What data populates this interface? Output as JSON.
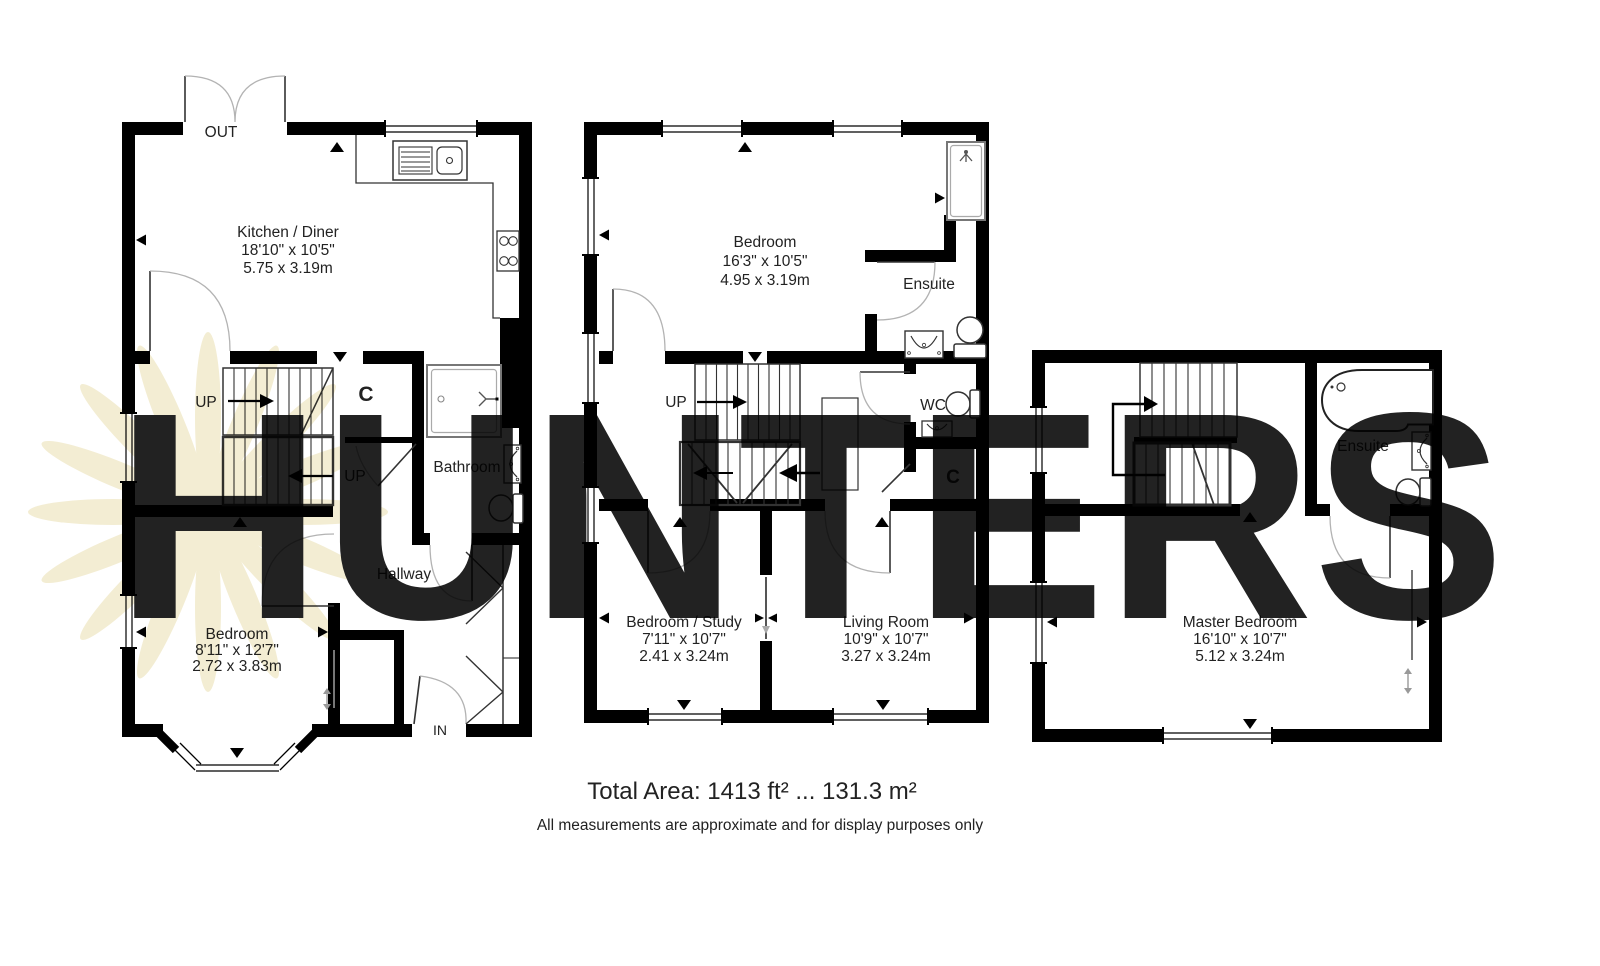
{
  "watermark": {
    "text": "HUNTERS",
    "color": "#F0E8C0"
  },
  "footer": {
    "total_area": "Total Area: 1413 ft² ... 131.3 m²",
    "disclaimer": "All measurements are approximate and for display purposes only"
  },
  "ground_floor": {
    "kitchen": {
      "name": "Kitchen / Diner",
      "imperial": "18'10\" x 10'5\"",
      "metric": "5.75 x 3.19m"
    },
    "bedroom": {
      "name": "Bedroom",
      "imperial": "8'11\" x 12'7\"",
      "metric": "2.72 x 3.83m"
    },
    "bathroom_label": "Bathroom",
    "hallway_label": "Hallway",
    "door_out": "OUT",
    "door_in": "IN",
    "up_label_1": "UP",
    "up_label_2": "UP",
    "cupboard_label": "C"
  },
  "first_floor": {
    "bedroom": {
      "name": "Bedroom",
      "imperial": "16'3\" x 10'5\"",
      "metric": "4.95 x 3.19m"
    },
    "bedroom_study": {
      "name": "Bedroom / Study",
      "imperial": "7'11\" x 10'7\"",
      "metric": "2.41 x 3.24m"
    },
    "living_room": {
      "name": "Living Room",
      "imperial": "10'9\" x 10'7\"",
      "metric": "3.27 x 3.24m"
    },
    "ensuite_label": "Ensuite",
    "wc_label": "WC",
    "cupboard_label": "C",
    "up_label": "UP"
  },
  "second_floor": {
    "master_bedroom": {
      "name": "Master Bedroom",
      "imperial": "16'10\" x 10'7\"",
      "metric": "5.12 x 3.24m"
    },
    "ensuite_label": "Ensuite"
  }
}
